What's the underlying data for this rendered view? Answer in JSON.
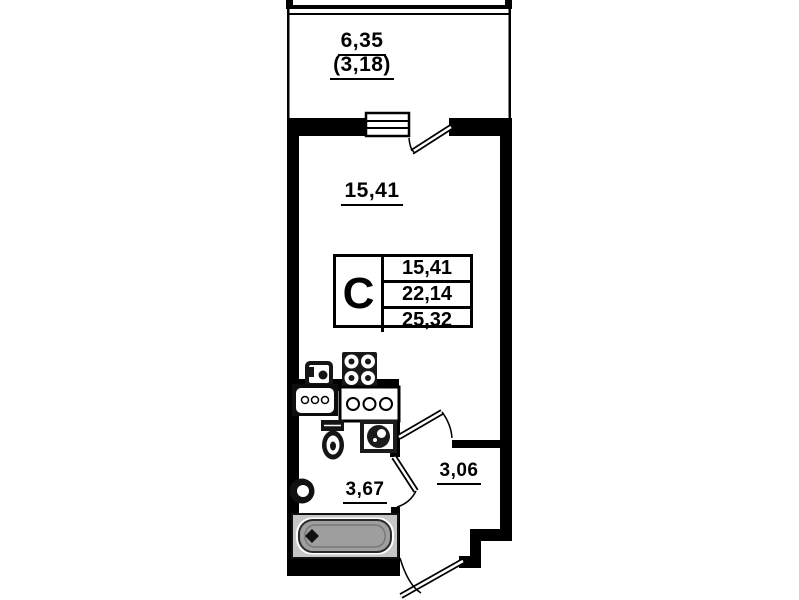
{
  "rooms": {
    "balcony": {
      "area": "6,35",
      "area_coefficient": "(3,18)"
    },
    "living_room": {
      "area": "15,41"
    },
    "bathroom": {
      "area": "3,67"
    },
    "hallway": {
      "area": "3,06"
    }
  },
  "legend": {
    "apartment_type": "С",
    "values": [
      "15,41",
      "22,14",
      "25,32"
    ]
  },
  "colors": {
    "wall": "#000000",
    "background": "#ffffff",
    "bathtub_fill": "#9e9e9e",
    "bathtub_frame": "#c6c6c6",
    "fixture_dark": "#161616"
  }
}
